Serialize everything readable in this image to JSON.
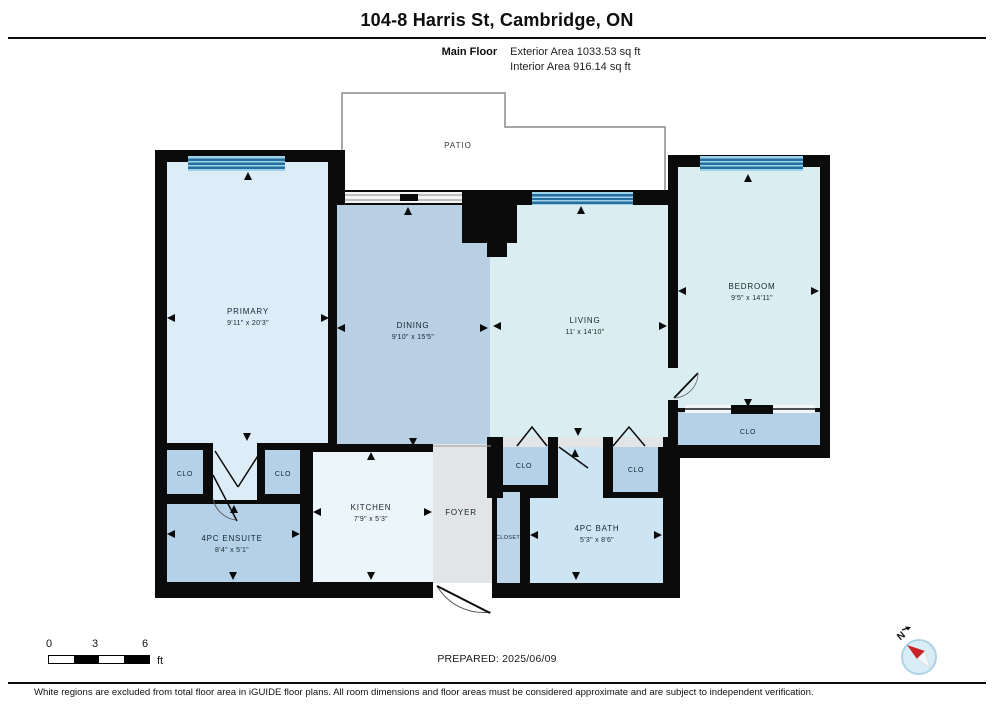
{
  "header": {
    "title": "104-8 Harris St, Cambridge, ON",
    "floor_label": "Main Floor",
    "exterior_area": "Exterior Area 1033.53 sq ft",
    "interior_area": "Interior Area 916.14 sq ft"
  },
  "rooms": {
    "patio": {
      "name": "PATIO"
    },
    "primary": {
      "name": "PRIMARY",
      "dims": "9'11\" x 20'3\""
    },
    "dining": {
      "name": "DINING",
      "dims": "9'10\" x 15'5\""
    },
    "living": {
      "name": "LIVING",
      "dims": "11' x 14'10\""
    },
    "bedroom": {
      "name": "BEDROOM",
      "dims": "9'5\" x 14'11\""
    },
    "bedroom_closet": {
      "name": "CLO"
    },
    "closet_left": {
      "name": "CLO"
    },
    "closet_right": {
      "name": "CLO"
    },
    "ensuite": {
      "name": "4PC ENSUITE",
      "dims": "8'4\" x 5'1\""
    },
    "kitchen": {
      "name": "KITCHEN",
      "dims": "7'9\" x 5'3\""
    },
    "foyer": {
      "name": "FOYER"
    },
    "closet": {
      "name": "CLOSET"
    },
    "bath_closet_left": {
      "name": "CLO"
    },
    "bath_closet_right": {
      "name": "CLO"
    },
    "bath": {
      "name": "4PC BATH",
      "dims": "5'3\" x 8'6\""
    }
  },
  "scale_bar": {
    "tick0": "0",
    "tick3": "3",
    "tick6": "6",
    "unit": "ft"
  },
  "prepared_label": "PREPARED: 2025/06/09",
  "compass": {
    "north_label": "N"
  },
  "footer": {
    "disclaimer": "White regions are excluded from total floor area in iGUIDE floor plans. All room dimensions and floor areas must be considered approximate and are subject to independent verification."
  },
  "colors": {
    "wall": "#0b0b0b",
    "window_band": "#63b2da",
    "window_stripe": "#246f9e",
    "primary_fill": "#dcedf8",
    "dining_fill": "#b9cfe3",
    "living_fill": "#daeef2",
    "closet_fill": "#b5d1e8",
    "bath_fill": "#cde4f3",
    "kitchen_fill": "#ecf6fa",
    "foyer_fill": "#e3e4e6",
    "compass_red": "#cc2127"
  }
}
